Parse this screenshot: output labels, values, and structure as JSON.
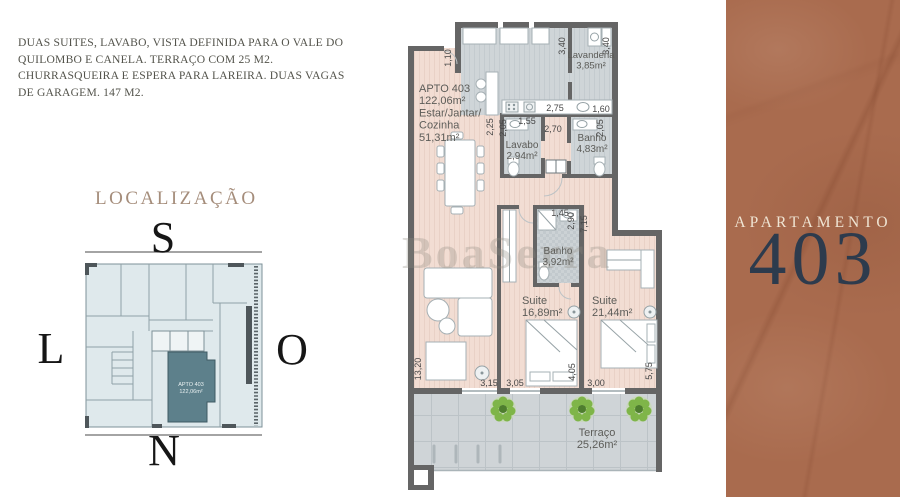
{
  "description": {
    "line1": "DUAS SUITES, LAVABO, VISTA DEFINIDA PARA O VALE DO",
    "line2": "QUILOMBO E CANELA. TERRAÇO COM 25 M2.",
    "line3": "CHURRASQUEIRA E ESPERA PARA LAREIRA. DUAS VAGAS",
    "line4": "DE GARAGEM. 147 M2."
  },
  "localizacao": {
    "title": "LOCALIZAÇÃO",
    "compass_top": "S",
    "compass_left": "L",
    "compass_right": "O",
    "compass_bottom": "N",
    "unit_label": "APTO 403",
    "unit_area": "122,06m²"
  },
  "panel": {
    "title": "APARTAMENTO",
    "number": "403"
  },
  "colors": {
    "panel_bg": "#a96b4e",
    "panel_number": "#2d3b4d",
    "panel_title": "#efe4d3",
    "wall": "#656565",
    "floor_pink": "#f2ddd3",
    "floor_gray": "#cdd3d6",
    "plant_green": "#7fb549",
    "miniplan_bg": "#dfe9ec",
    "miniplan_highlight": "#5d808b",
    "heading_brown": "#a58d7b"
  },
  "floorplan": {
    "watermark": "BoaSerra",
    "room_labels": [
      {
        "lines": [
          "APTO 403",
          "122,06m²",
          "Estar/Jantar/",
          "Cozinha",
          "51,31m²"
        ],
        "x": 419,
        "y": 92,
        "size": 11,
        "anchor": "start"
      },
      {
        "lines": [
          "Lavanderia",
          "3,85m²"
        ],
        "x": 591,
        "y": 58,
        "size": 9.5,
        "anchor": "middle"
      },
      {
        "lines": [
          "Lavabo",
          "2,94m²"
        ],
        "x": 522,
        "y": 148,
        "size": 10,
        "anchor": "middle"
      },
      {
        "lines": [
          "Banho",
          "4,83m²"
        ],
        "x": 592,
        "y": 141,
        "size": 10,
        "anchor": "middle"
      },
      {
        "lines": [
          "Banho",
          "3,92m²"
        ],
        "x": 558,
        "y": 254,
        "size": 10,
        "anchor": "middle"
      },
      {
        "lines": [
          "Suite",
          "16,89m²"
        ],
        "x": 522,
        "y": 304,
        "size": 11,
        "anchor": "start"
      },
      {
        "lines": [
          "Suite",
          "21,44m²"
        ],
        "x": 592,
        "y": 304,
        "size": 11,
        "anchor": "start"
      },
      {
        "lines": [
          "Terraço",
          "25,26m²"
        ],
        "x": 597,
        "y": 436,
        "size": 11,
        "anchor": "middle"
      }
    ],
    "dimensions": [
      {
        "t": "1,10",
        "x": 451,
        "y": 58,
        "r": -90
      },
      {
        "t": "3,40",
        "x": 565,
        "y": 46,
        "r": -90
      },
      {
        "t": "3,40",
        "x": 609,
        "y": 46,
        "r": -90
      },
      {
        "t": "2,75",
        "x": 555,
        "y": 111,
        "r": 0
      },
      {
        "t": "1,60",
        "x": 601,
        "y": 112,
        "r": 0
      },
      {
        "t": "2,25",
        "x": 493,
        "y": 127,
        "r": -90
      },
      {
        "t": "2,05",
        "x": 506,
        "y": 128,
        "r": -90
      },
      {
        "t": "1,55",
        "x": 527,
        "y": 124,
        "r": 0
      },
      {
        "t": "2,70",
        "x": 553,
        "y": 132,
        "r": 0
      },
      {
        "t": "2,05",
        "x": 603,
        "y": 128,
        "r": -90
      },
      {
        "t": "1,45",
        "x": 560,
        "y": 216,
        "r": 0
      },
      {
        "t": "2,90",
        "x": 574,
        "y": 221,
        "r": -90
      },
      {
        "t": "7,15",
        "x": 587,
        "y": 224,
        "r": -90
      },
      {
        "t": "13,20",
        "x": 421,
        "y": 369,
        "r": -90
      },
      {
        "t": "3,15",
        "x": 489,
        "y": 386,
        "r": 0
      },
      {
        "t": "3,05",
        "x": 515,
        "y": 386,
        "r": 0
      },
      {
        "t": "4,05",
        "x": 575,
        "y": 372,
        "r": -90
      },
      {
        "t": "3,00",
        "x": 596,
        "y": 386,
        "r": 0
      },
      {
        "t": "5,75",
        "x": 652,
        "y": 371,
        "r": -90
      }
    ]
  }
}
